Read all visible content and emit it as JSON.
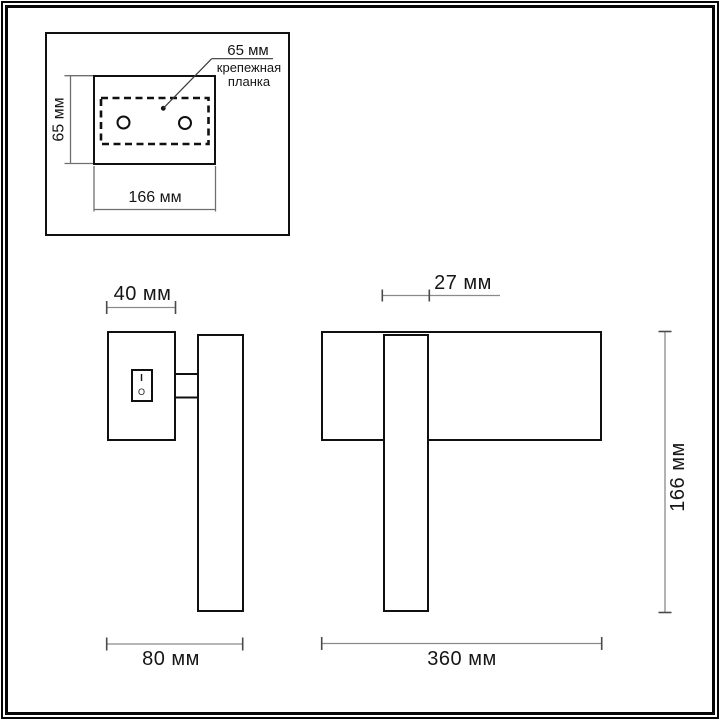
{
  "colors": {
    "background": "#ffffff",
    "outline": "#101010",
    "dimension_line": "#8a8a8a",
    "dimension_tick": "#4a4a4a",
    "text": "#161616"
  },
  "inset": {
    "callout_dim": "65 мм",
    "part_line1": "крепежная",
    "part_line2": "планка",
    "height_dim": "65 мм",
    "width_dim": "166 мм",
    "holes_count": 2
  },
  "side_view": {
    "plate_width_dim": "40 мм",
    "depth_dim": "80 мм",
    "switch_on": "I",
    "switch_off": "O"
  },
  "front_view": {
    "arm_width_dim": "27 мм",
    "total_width_dim": "360 мм",
    "height_dim": "166 мм"
  }
}
